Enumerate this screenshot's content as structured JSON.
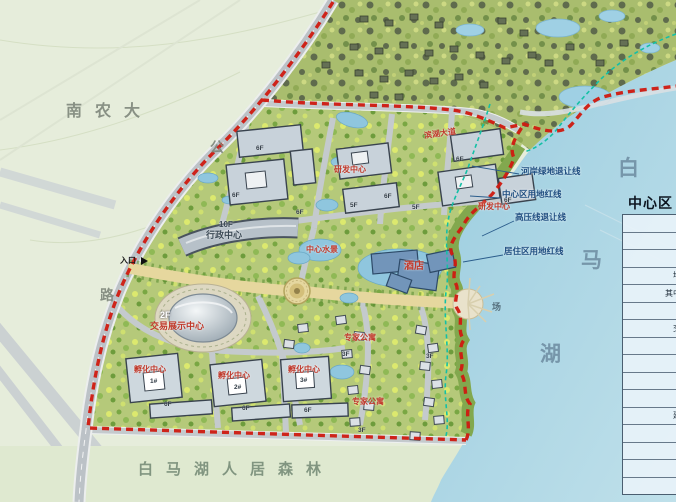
{
  "map": {
    "campus_label": "南农大",
    "road_name_chars": [
      "公",
      "路"
    ],
    "lake_name_chars": [
      "白",
      "马",
      "湖"
    ],
    "forest_label": "白马湖人居森林",
    "entrance_label": "入口",
    "plaza_label": "场",
    "setback_labels": [
      "河岸绿地退让线",
      "中心区用地红线",
      "高压线退让线",
      "居住区用地红线"
    ],
    "buildings": {
      "admin_floor": "10F",
      "admin_name": "行政中心",
      "expo_floor": "2F",
      "expo_name": "交易展示中心",
      "rd_center_1": "研发中心",
      "rd_center_2": "研发中心",
      "hotel": "酒店",
      "central_waterscape": "中心水景",
      "lakeside_avenue": "滨湖大道",
      "incubator_1": "孵化中心",
      "incubator_2": "孵化中心",
      "incubator_3": "孵化中心",
      "expert_apartment_1": "专家公寓",
      "expert_apartment_2": "专家公寓"
    },
    "floor_tags": [
      "6F",
      "6F",
      "6F",
      "5F",
      "6F",
      "5F",
      "6F",
      "6F",
      "6F",
      "6F",
      "6F",
      "3F",
      "3F",
      "3F"
    ],
    "unit_tags": [
      "1#",
      "2#",
      "3#"
    ],
    "colors": {
      "boundary_red": "#cf1a10",
      "setback_teal": "#14c0a6",
      "lake_blue": "#a7d2e5",
      "site_green": "#b5c97a",
      "label_red": "#c0392b"
    }
  },
  "table": {
    "title": "中心区",
    "rows": [
      "名称",
      "规划总用地",
      "总建筑面积",
      "地上建筑面积",
      "其中：行政中心",
      "会展中心",
      "交易展示中心",
      "研发中心",
      "酒店",
      "配套公建",
      "孵化中心",
      "建筑占地面积",
      "容积率",
      "建筑密度",
      "绿地率",
      "机动车位"
    ]
  }
}
